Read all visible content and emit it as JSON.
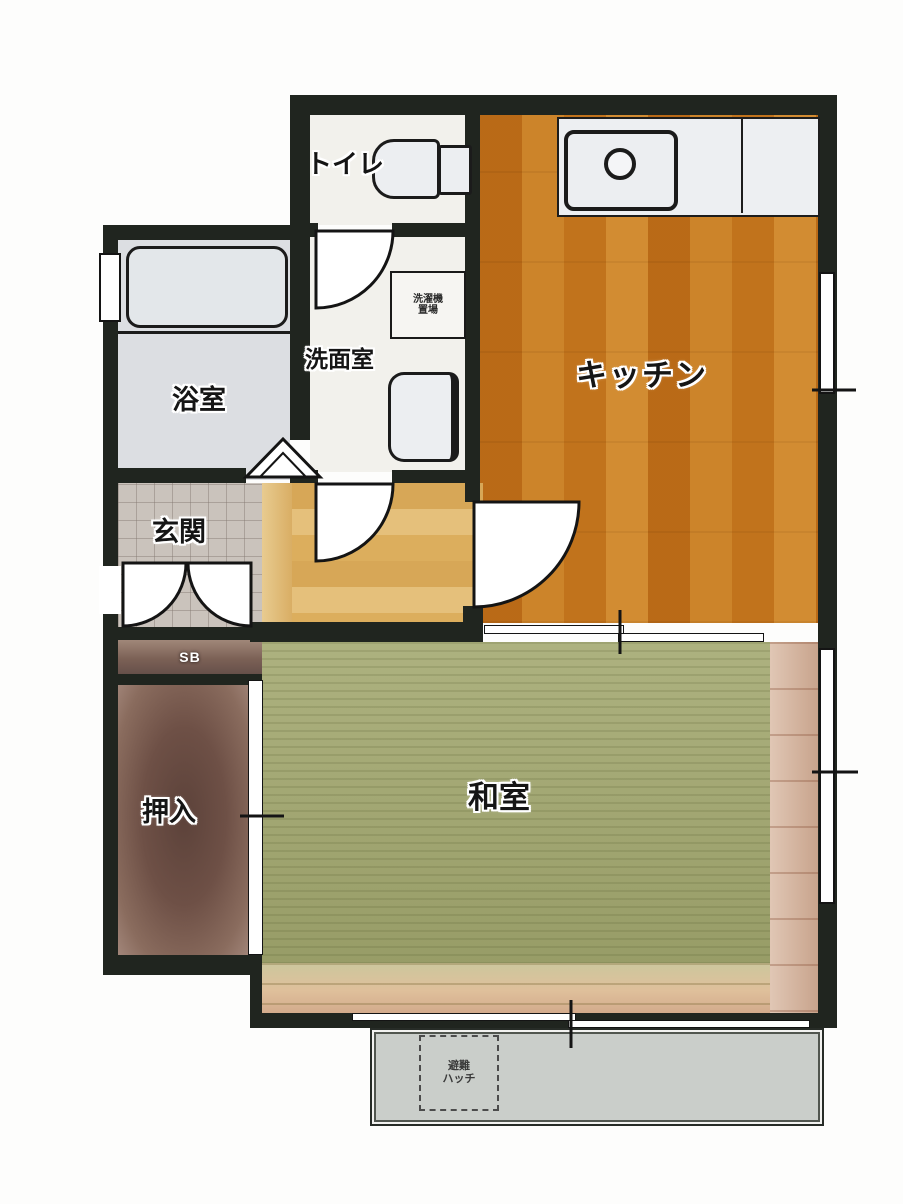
{
  "plan_title": "1K apartment floor plan",
  "rooms": {
    "toilet": {
      "label": "トイレ"
    },
    "kitchen": {
      "label": "キッチン"
    },
    "bathroom": {
      "label": "浴室"
    },
    "washroom": {
      "label": "洗面室"
    },
    "laundry_space": {
      "line1": "洗濯機",
      "line2": "置場"
    },
    "entrance": {
      "label": "玄関"
    },
    "shoe_box": {
      "label": "SB"
    },
    "closet": {
      "label": "押入"
    },
    "japanese_room": {
      "label": "和室"
    },
    "evacuation_hatch": {
      "line1": "避難",
      "line2": "ハッチ"
    }
  },
  "colors": {
    "wall": "#20251f",
    "tatami_green": "#a4a971",
    "kitchen_wood": "#dfae5c",
    "hall_wood": "#d9ae64",
    "entrance_tile": "#cac3bc",
    "bathroom_gray": "#dcdee2",
    "closet_brown": "#6e5046",
    "wood_trim": "#d6b49c",
    "balcony_gray": "#caceca",
    "room_white": "#f2f1ec"
  }
}
